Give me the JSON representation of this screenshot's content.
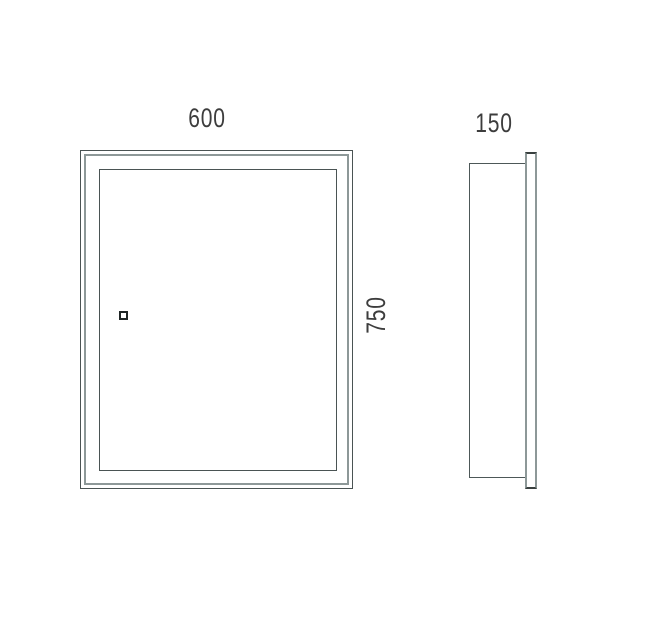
{
  "drawing": {
    "type": "technical-dimension-drawing",
    "subject": "mirror-cabinet",
    "front_view": {
      "width_label": "600",
      "height_label": "750",
      "sensor_icon": "touch-switch-square"
    },
    "side_view": {
      "depth_label": "150"
    }
  },
  "colors": {
    "background": "#ffffff",
    "line_dark": "#4a5353",
    "line_gray": "#8d9898",
    "cap_dark": "#39403f",
    "text": "#3d3d3d"
  }
}
